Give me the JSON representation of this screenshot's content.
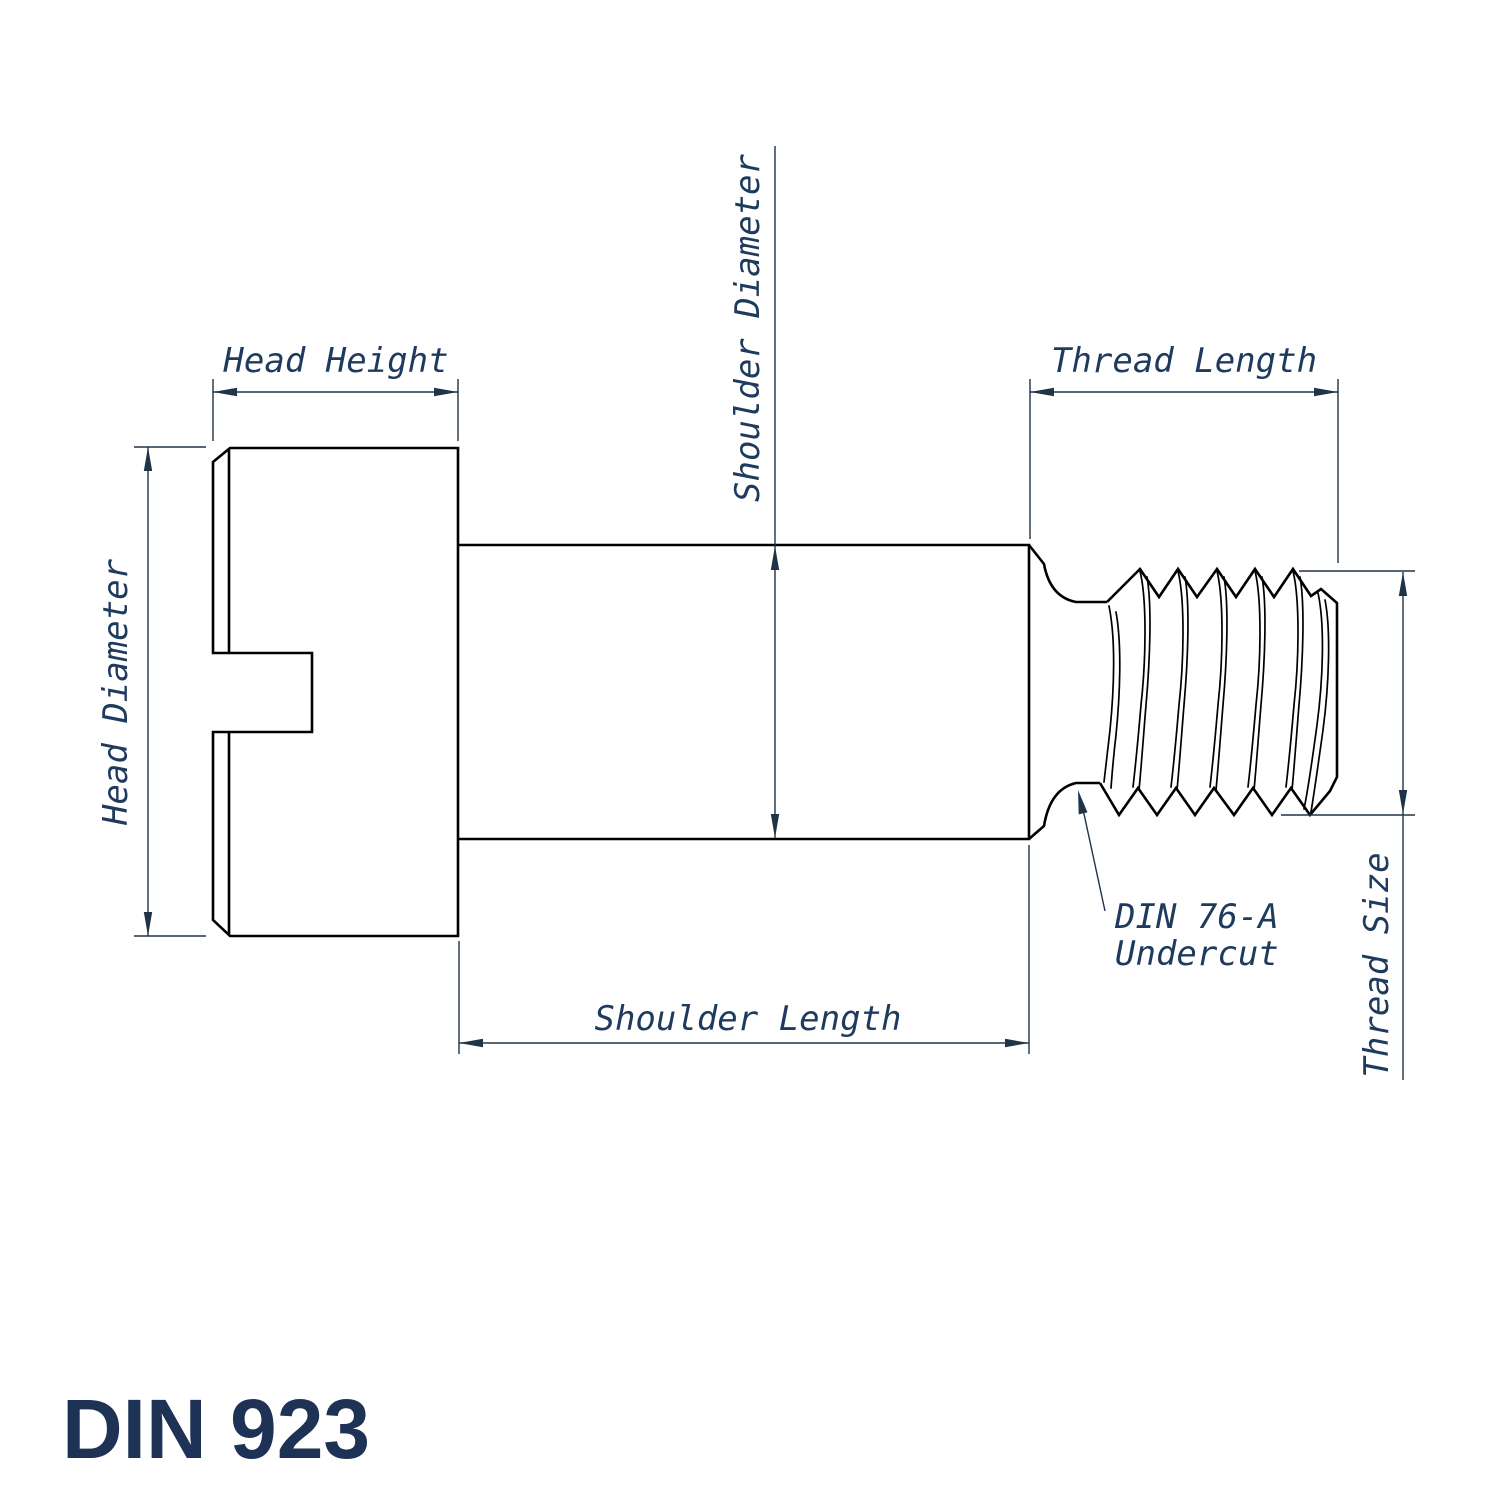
{
  "title": {
    "text": "DIN 923"
  },
  "colors": {
    "outline": "#000000",
    "dimension_lines": "#203448",
    "label_text": "#1e3a5d",
    "title_text": "#1d3254",
    "background": "#ffffff"
  },
  "dimensions": {
    "head_height": {
      "label": "Head Height",
      "orientation": "horizontal"
    },
    "head_diameter": {
      "label": "Head Diameter",
      "orientation": "vertical"
    },
    "shoulder_diameter": {
      "label": "Shoulder Diameter",
      "orientation": "vertical"
    },
    "shoulder_length": {
      "label": "Shoulder Length",
      "orientation": "horizontal"
    },
    "thread_length": {
      "label": "Thread Length",
      "orientation": "horizontal"
    },
    "thread_size": {
      "label": "Thread Size",
      "orientation": "vertical"
    }
  },
  "leader_note": {
    "line1": "DIN 76-A",
    "line2": "Undercut"
  }
}
